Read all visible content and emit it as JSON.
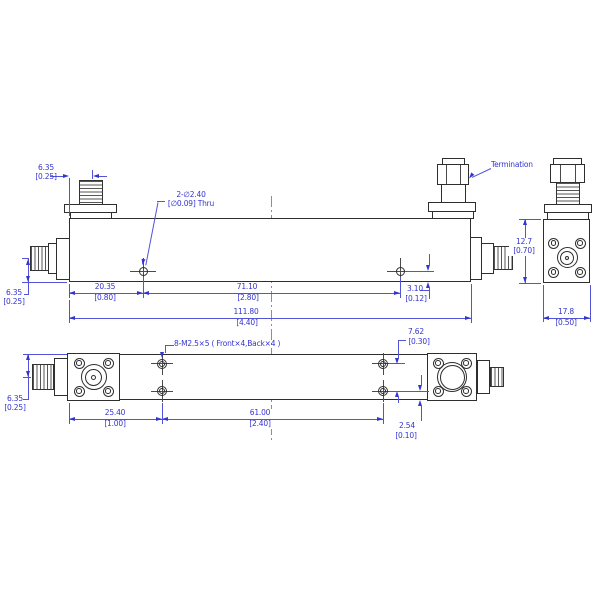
{
  "labels": {
    "termination": "Termination",
    "through_hole_note": {
      "line1": "2-∅2.40",
      "line2": "[∅0.09] Thru"
    },
    "tapped_hole_note": "8-M2.5×5 ( Front×4,Back×4 )"
  },
  "dims": {
    "connector_offset": {
      "mm": "6.35",
      "in": "[0.25]"
    },
    "hole1_x": {
      "mm": "20.35",
      "in": "[0.80]"
    },
    "hole_span": {
      "mm": "71.10",
      "in": "[2.80]"
    },
    "body_length": {
      "mm": "111.80",
      "in": "[4.40]"
    },
    "hole_edge_offset": {
      "mm": "3.10",
      "in": "[0.12]"
    },
    "body_height": {
      "mm": "12.7",
      "in": "[0.70]"
    },
    "body_width": {
      "mm": "17.8",
      "in": "[0.50]"
    },
    "tap_row_span": {
      "mm": "7.62",
      "in": "[0.30]"
    },
    "tap_edge_offset": {
      "mm": "2.54",
      "in": "[0.10]"
    },
    "tap_col1_x": {
      "mm": "25.40",
      "in": "[1.00]"
    },
    "tap_col_span": {
      "mm": "61.00",
      "in": "[2.40]"
    }
  },
  "colors": {
    "dimension_text": "#3434cf",
    "dimension_line": "#5353d6",
    "outline": "#2e2e2e",
    "centerline_red": "#d4706e",
    "background": "#ffffff"
  }
}
